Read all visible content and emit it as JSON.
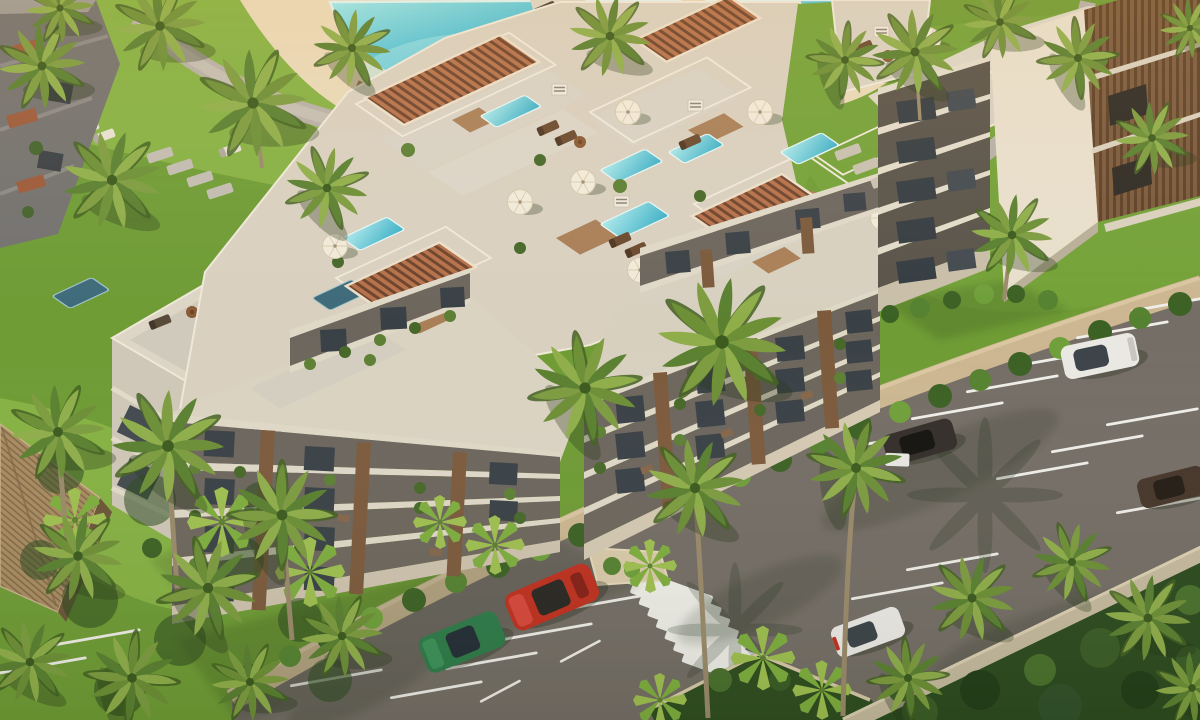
{
  "scene": {
    "title": "Aerial golden-hour render of a tropical beachfront apartment complex",
    "view": "aerial oblique 3D architectural rendering",
    "description": "Cream stepped apartment blocks with rooftop plunge pools, terracotta slat pergolas and white umbrellas; lagoon-style turquoise resort pool with timber boardwalk upper-left; palm gardens; diagonal asphalt road with angled parking stalls, zebra crosswalk and boundary wall before dense jungle at lower right."
  },
  "colors": {
    "grass_base": "#6f9c35",
    "grass_bright": "#86b243",
    "lawn_right": "#74a238",
    "jungle": "#2c4a1e",
    "sand_deck": "#ead9b8",
    "boardwalk": "#b07f52",
    "path": "#b7b1a7",
    "asphalt": "#756e66",
    "sidewalk": "#cdb792",
    "marking": "#efeee8",
    "wall": "#c6ba9f",
    "pool_light": "#8fe4e8",
    "pool_deep": "#2593b8",
    "plunge_pool": "#5fd0da",
    "concrete_light": "#e7dfd0",
    "concrete_mid": "#d9d0bf",
    "concrete_shade": "#6d665d",
    "slab": "#e0d8c7",
    "window": "#3a4146",
    "wood": "#7c5a3c",
    "pergola": "#b5714a",
    "umbrella": "#f2ead9",
    "thatch": "#a98c5f",
    "palm_frond": "#7d9c3f"
  },
  "vehicles": [
    {
      "name": "red-sports-car",
      "color": "#c0301f",
      "location": "parked bottom-center, nose to sidewalk"
    },
    {
      "name": "green-hatchback",
      "color": "#2e7b49",
      "location": "parked bottom-center-left"
    },
    {
      "name": "white-suv",
      "color": "#eae8e3",
      "location": "upper-right stalls near curb"
    },
    {
      "name": "black-car",
      "color": "#332e29",
      "location": "mid-right stalls, white door open"
    },
    {
      "name": "brown-car",
      "color": "#46362a",
      "location": "right edge stalls"
    },
    {
      "name": "white-hatchback",
      "color": "#eceae6",
      "location": "lower-right stalls near wall"
    }
  ],
  "road": {
    "surface": "asphalt",
    "crosswalk_stripes": 9,
    "parking_rows": 3,
    "stall_lines": 19
  },
  "buildings": {
    "main_complex": {
      "style": "stepped cream blocks with wood-slat piers and planted balconies",
      "floors_visible": 4,
      "rooftop_plunge_pools": 7,
      "pergolas": 4,
      "rooftop_umbrellas": 8
    },
    "right_tower": {
      "style": "white tower with vertical wood-slat face",
      "rooftop_pool": 1,
      "pergola": 1
    },
    "left_building": {
      "style": "cream block with furnished roof terrace"
    },
    "far_left_building": {
      "style": "shaded grey block with terracotta balconies"
    },
    "pavilion": {
      "style": "thatched palapa roof among palms, bottom-left"
    }
  },
  "amenities": {
    "main_pool": "lagoon-style turquoise pool",
    "sun_loungers": 14,
    "boardwalk": "curved timber deck",
    "stepping_stone_paths": 2
  },
  "vegetation": {
    "palm_trees": 33,
    "fan_palms": 8,
    "hedges": "along curb and building bases",
    "jungle": "dense canopy beyond boundary wall"
  }
}
